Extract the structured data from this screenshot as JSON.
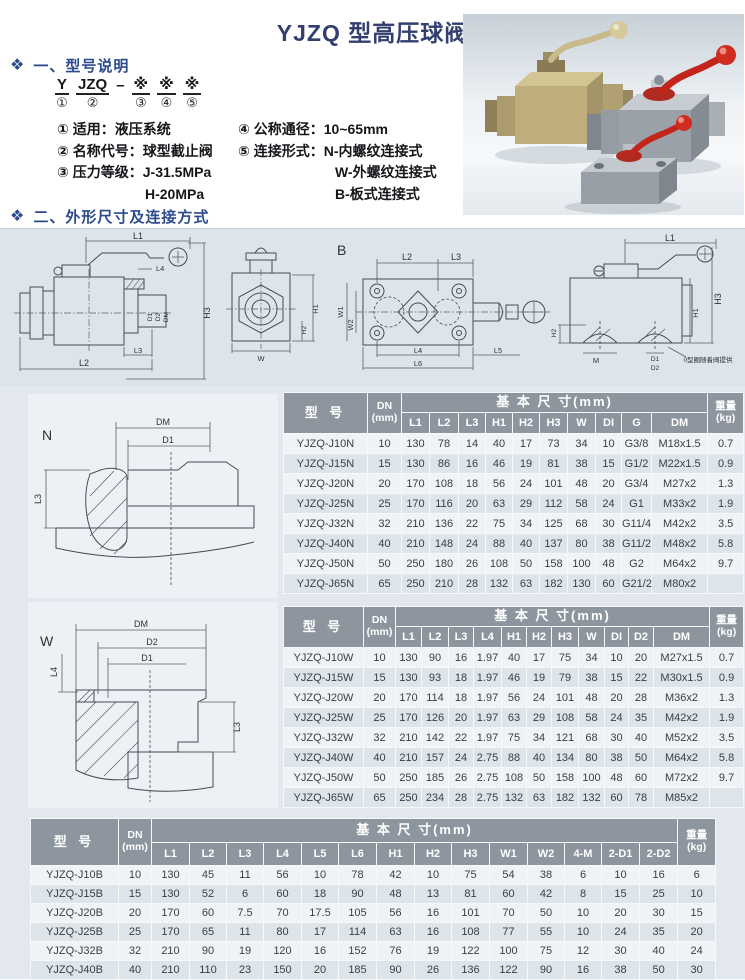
{
  "header": {
    "title": "YJZQ 型高压球阀"
  },
  "section1": {
    "bullet": "❖",
    "heading": "一、型号说明",
    "code": {
      "y": "Y",
      "jzq": "JZQ",
      "dash": "–",
      "star": "※",
      "n1": "①",
      "n2": "②",
      "n3": "③",
      "n4": "④",
      "n5": "⑤"
    },
    "legend_left": [
      "① 适用：液压系统",
      "② 名称代号：球型截止阀",
      "③ 压力等级：J-31.5MPa",
      "H-20MPa"
    ],
    "legend_right": [
      "④ 公称通径：10~65mm",
      "⑤ 连接形式：N-内螺纹连接式",
      "W-外螺纹连接式",
      "B-板式连接式"
    ]
  },
  "section2": {
    "bullet": "❖",
    "heading": "二、外形尺寸及连接方式"
  },
  "drawings": {
    "band": {
      "a_l1": "L1",
      "a_l2": "L2",
      "a_l3": "L3",
      "a_l4": "L4",
      "a_h3": "H3",
      "a_d1": "D1",
      "a_d2": "D2",
      "a_dm": "DM",
      "f_w": "W",
      "f_h1": "H1",
      "f_h2": "H2",
      "b_label": "B",
      "p_l2": "L2",
      "p_l3": "L3",
      "p_l4": "L4",
      "p_l5": "L5",
      "p_l6": "L6",
      "p_w1": "W1",
      "p_w2": "W2",
      "s_l1": "L1",
      "s_h1": "H1",
      "s_h2": "H2",
      "s_h3": "H3",
      "s_m": "M",
      "s_d1": "D1",
      "s_d2": "D2",
      "note": "0型圈随着阀提供"
    },
    "n_view": {
      "label": "N",
      "dm": "DM",
      "d1": "D1",
      "l3": "L3"
    },
    "w_view": {
      "label": "W",
      "dm": "DM",
      "d2": "D2",
      "d1": "D1",
      "l4": "L4",
      "l3": "L3"
    }
  },
  "tables": {
    "n": {
      "col_model": "型 号",
      "col_dn": [
        "DN",
        "(mm)"
      ],
      "group_header": "基 本 尺 寸(mm)",
      "dim_cols": [
        "L1",
        "L2",
        "L3",
        "H1",
        "H2",
        "H3",
        "W",
        "DI",
        "G",
        "DM"
      ],
      "col_weight": [
        "重量",
        "(kg)"
      ],
      "rows": [
        [
          "YJZQ-J10N",
          "10",
          "130",
          "78",
          "14",
          "40",
          "17",
          "73",
          "34",
          "10",
          "G3/8",
          "M18x1.5",
          "0.7"
        ],
        [
          "YJZQ-J15N",
          "15",
          "130",
          "86",
          "16",
          "46",
          "19",
          "81",
          "38",
          "15",
          "G1/2",
          "M22x1.5",
          "0.9"
        ],
        [
          "YJZQ-J20N",
          "20",
          "170",
          "108",
          "18",
          "56",
          "24",
          "101",
          "48",
          "20",
          "G3/4",
          "M27x2",
          "1.3"
        ],
        [
          "YJZQ-J25N",
          "25",
          "170",
          "116",
          "20",
          "63",
          "29",
          "112",
          "58",
          "24",
          "G1",
          "M33x2",
          "1.9"
        ],
        [
          "YJZQ-J32N",
          "32",
          "210",
          "136",
          "22",
          "75",
          "34",
          "125",
          "68",
          "30",
          "G11/4",
          "M42x2",
          "3.5"
        ],
        [
          "YJZQ-J40N",
          "40",
          "210",
          "148",
          "24",
          "88",
          "40",
          "137",
          "80",
          "38",
          "G11/2",
          "M48x2",
          "5.8"
        ],
        [
          "YJZQ-J50N",
          "50",
          "250",
          "180",
          "26",
          "108",
          "50",
          "158",
          "100",
          "48",
          "G2",
          "M64x2",
          "9.7"
        ],
        [
          "YJZQ-J65N",
          "65",
          "250",
          "210",
          "28",
          "132",
          "63",
          "182",
          "130",
          "60",
          "G21/2",
          "M80x2",
          ""
        ]
      ]
    },
    "w": {
      "col_model": "型 号",
      "col_dn": [
        "DN",
        "(mm)"
      ],
      "group_header": "基 本 尺 寸(mm)",
      "dim_cols": [
        "L1",
        "L2",
        "L3",
        "L4",
        "H1",
        "H2",
        "H3",
        "W",
        "DI",
        "D2",
        "DM"
      ],
      "col_weight": [
        "重量",
        "(kg)"
      ],
      "rows": [
        [
          "YJZQ-J10W",
          "10",
          "130",
          "90",
          "16",
          "1.97",
          "40",
          "17",
          "75",
          "34",
          "10",
          "20",
          "M27x1.5",
          "0.7"
        ],
        [
          "YJZQ-J15W",
          "15",
          "130",
          "93",
          "18",
          "1.97",
          "46",
          "19",
          "79",
          "38",
          "15",
          "22",
          "M30x1.5",
          "0.9"
        ],
        [
          "YJZQ-J20W",
          "20",
          "170",
          "114",
          "18",
          "1.97",
          "56",
          "24",
          "101",
          "48",
          "20",
          "28",
          "M36x2",
          "1.3"
        ],
        [
          "YJZQ-J25W",
          "25",
          "170",
          "126",
          "20",
          "1.97",
          "63",
          "29",
          "108",
          "58",
          "24",
          "35",
          "M42x2",
          "1.9"
        ],
        [
          "YJZQ-J32W",
          "32",
          "210",
          "142",
          "22",
          "1.97",
          "75",
          "34",
          "121",
          "68",
          "30",
          "40",
          "M52x2",
          "3.5"
        ],
        [
          "YJZQ-J40W",
          "40",
          "210",
          "157",
          "24",
          "2.75",
          "88",
          "40",
          "134",
          "80",
          "38",
          "50",
          "M64x2",
          "5.8"
        ],
        [
          "YJZQ-J50W",
          "50",
          "250",
          "185",
          "26",
          "2.75",
          "108",
          "50",
          "158",
          "100",
          "48",
          "60",
          "M72x2",
          "9.7"
        ],
        [
          "YJZQ-J65W",
          "65",
          "250",
          "234",
          "28",
          "2.75",
          "132",
          "63",
          "182",
          "132",
          "60",
          "78",
          "M85x2",
          ""
        ]
      ]
    },
    "b": {
      "col_model": "型 号",
      "col_dn": [
        "DN",
        "(mm)"
      ],
      "group_header": "基 本 尺 寸(mm)",
      "dim_cols": [
        "L1",
        "L2",
        "L3",
        "L4",
        "L5",
        "L6",
        "H1",
        "H2",
        "H3",
        "W1",
        "W2",
        "4-M",
        "2-D1",
        "2-D2"
      ],
      "col_weight": [
        "重量",
        "(kg)"
      ],
      "rows": [
        [
          "YJZQ-J10B",
          "10",
          "130",
          "45",
          "11",
          "56",
          "10",
          "78",
          "42",
          "10",
          "75",
          "54",
          "38",
          "6",
          "10",
          "16",
          "6"
        ],
        [
          "YJZQ-J15B",
          "15",
          "130",
          "52",
          "6",
          "60",
          "18",
          "90",
          "48",
          "13",
          "81",
          "60",
          "42",
          "8",
          "15",
          "25",
          "10"
        ],
        [
          "YJZQ-J20B",
          "20",
          "170",
          "60",
          "7.5",
          "70",
          "17.5",
          "105",
          "56",
          "16",
          "101",
          "70",
          "50",
          "10",
          "20",
          "30",
          "15"
        ],
        [
          "YJZQ-J25B",
          "25",
          "170",
          "65",
          "11",
          "80",
          "17",
          "114",
          "63",
          "16",
          "108",
          "77",
          "55",
          "10",
          "24",
          "35",
          "20"
        ],
        [
          "YJZQ-J32B",
          "32",
          "210",
          "90",
          "19",
          "120",
          "16",
          "152",
          "76",
          "19",
          "122",
          "100",
          "75",
          "12",
          "30",
          "40",
          "24"
        ],
        [
          "YJZQ-J40B",
          "40",
          "210",
          "110",
          "23",
          "150",
          "20",
          "185",
          "90",
          "26",
          "136",
          "122",
          "90",
          "16",
          "38",
          "50",
          "30"
        ]
      ]
    }
  }
}
